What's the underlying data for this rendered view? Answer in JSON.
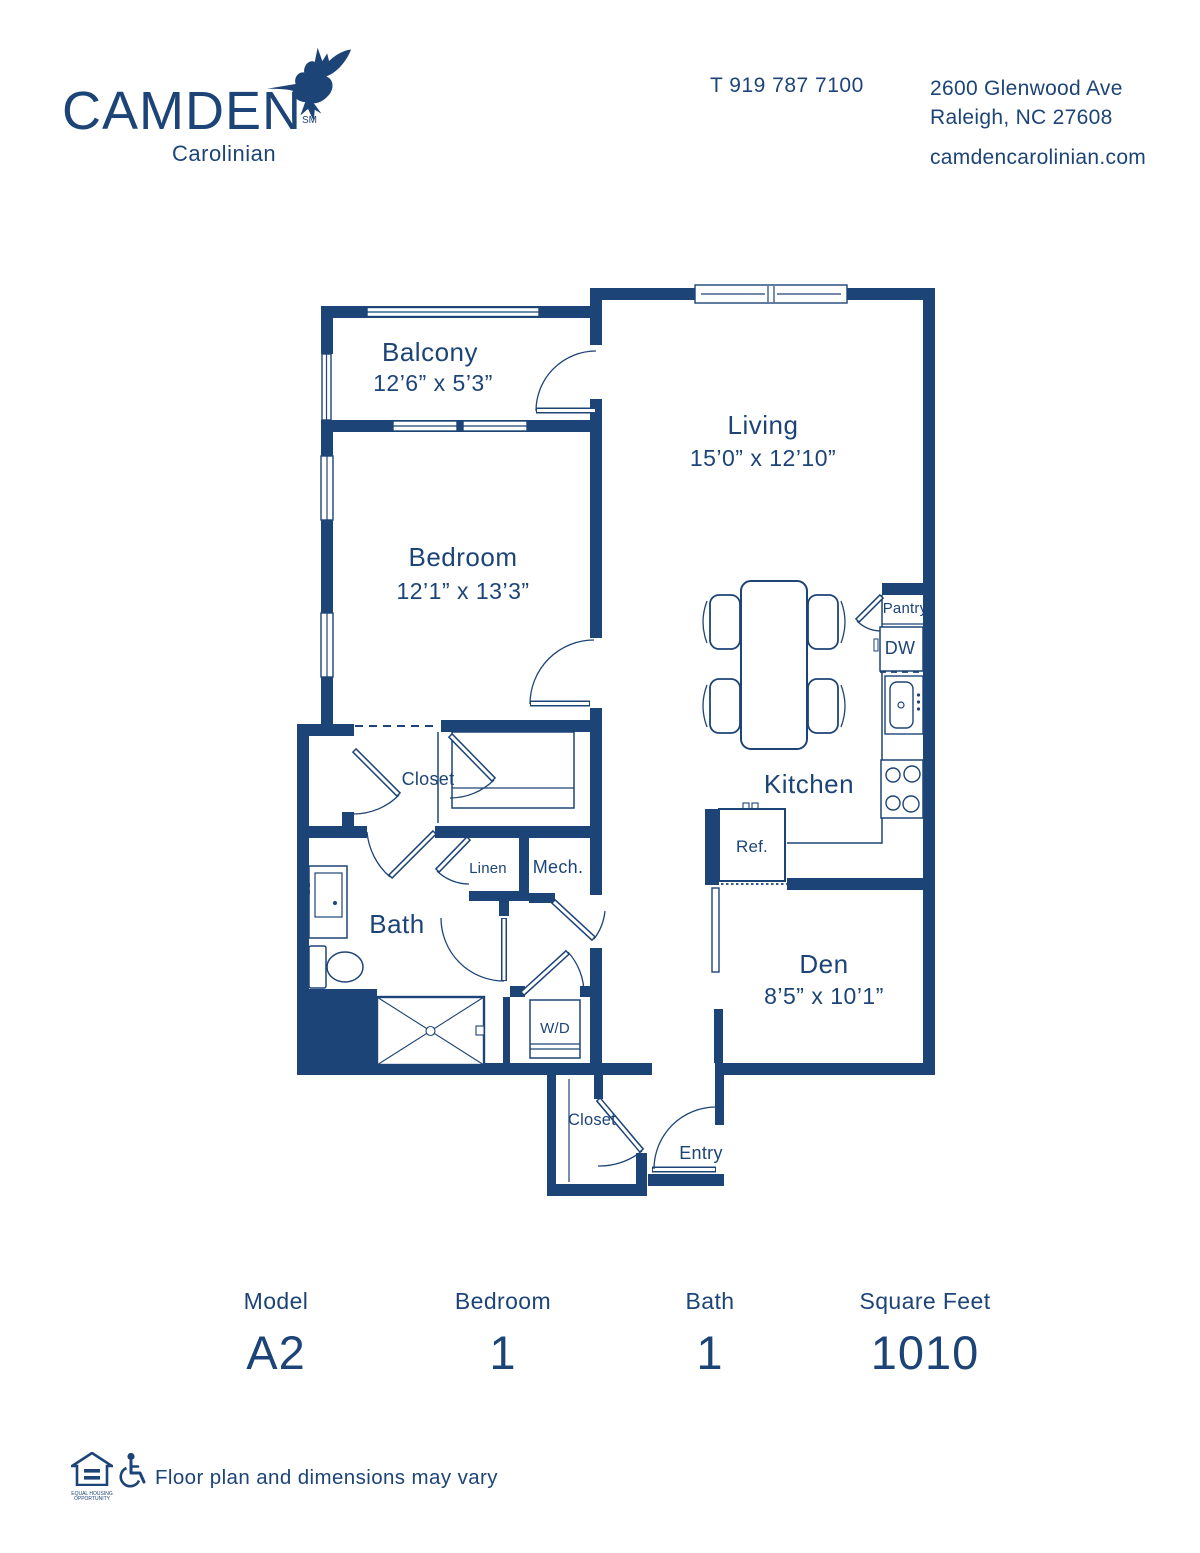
{
  "colors": {
    "navy": "#1d4477",
    "background": "#ffffff"
  },
  "header": {
    "brand": "CAMDEN",
    "brand_mark": "SM",
    "community": "Carolinian",
    "phone": "T 919 787 7100",
    "address_line1": "2600 Glenwood Ave",
    "address_line2": "Raleigh, NC 27608",
    "website": "camdencarolinian.com"
  },
  "floorplan": {
    "rooms": {
      "balcony": {
        "name": "Balcony",
        "dims": "12’6” x 5’3”"
      },
      "living": {
        "name": "Living",
        "dims": "15’0” x 12’10”"
      },
      "bedroom": {
        "name": "Bedroom",
        "dims": "12’1” x 13’3”"
      },
      "den": {
        "name": "Den",
        "dims": "8’5” x 10’1”"
      },
      "kitchen": {
        "name": "Kitchen"
      },
      "bath": {
        "name": "Bath"
      },
      "closet_bedroom": {
        "name": "Closet"
      },
      "closet_entry": {
        "name": "Closet"
      },
      "entry": {
        "name": "Entry"
      },
      "linen": {
        "name": "Linen"
      },
      "mech": {
        "name": "Mech."
      },
      "wd": {
        "name": "W/D"
      },
      "pantry": {
        "name": "Pantry"
      },
      "dw": {
        "name": "DW"
      },
      "ref": {
        "name": "Ref."
      }
    }
  },
  "stats": {
    "columns": [
      {
        "label": "Model",
        "value": "A2"
      },
      {
        "label": "Bedroom",
        "value": "1"
      },
      {
        "label": "Bath",
        "value": "1"
      },
      {
        "label": "Square Feet",
        "value": "1010"
      }
    ]
  },
  "footer": {
    "equal_housing": "EQUAL HOUSING\nOPPORTUNITY",
    "disclaimer": "Floor plan and dimensions may vary"
  }
}
